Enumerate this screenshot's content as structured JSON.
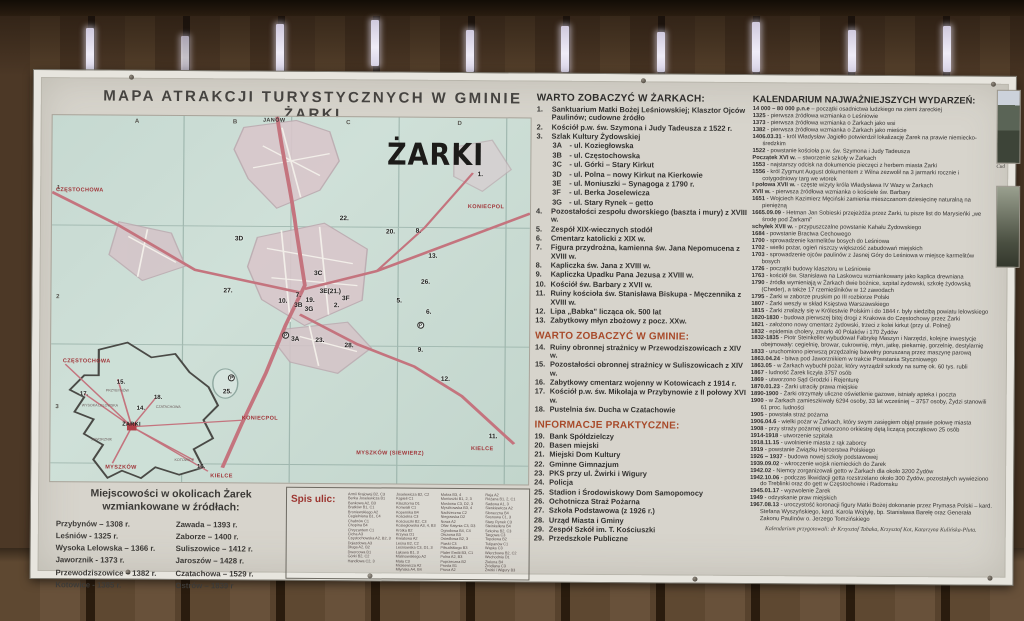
{
  "title": "MAPA ATRAKCJI TURYSTYCZNYCH  W GMINIE ŻARKI",
  "map": {
    "name_label": "ŻARKI",
    "inset_label": "ŻARKI",
    "grid_letters": [
      {
        "t": "A",
        "x": 17.2,
        "y": 0.8
      },
      {
        "t": "B",
        "x": 37.7,
        "y": 0.8
      },
      {
        "t": "C",
        "x": 61.4,
        "y": 0.8
      },
      {
        "t": "D",
        "x": 84.7,
        "y": 0.8
      }
    ],
    "grid_rows": [
      {
        "t": "1",
        "x": 1,
        "y": 19
      },
      {
        "t": "2",
        "x": 1,
        "y": 49
      },
      {
        "t": "3",
        "x": 1,
        "y": 79
      }
    ],
    "red_labels": [
      {
        "t": "JANÓW",
        "x": 44,
        "y": 0.4,
        "cls": "dark"
      },
      {
        "t": "CZĘSTOCHOWA",
        "x": 0.8,
        "y": 19.6
      },
      {
        "t": "KONIECPOL",
        "x": 87,
        "y": 23.5
      },
      {
        "t": "KIELCE",
        "x": 88,
        "y": 89.5
      },
      {
        "t": "MYSZKÓW (SIEWIERZ)",
        "x": 64,
        "y": 91
      },
      {
        "t": "CZĘSTOCHOWA",
        "x": 2.5,
        "y": 66.3
      },
      {
        "t": "KONIECPOL",
        "x": 40,
        "y": 81.6
      },
      {
        "t": "MYSZKÓW",
        "x": 11.5,
        "y": 95.3
      },
      {
        "t": "KIELCE",
        "x": 33.5,
        "y": 97.6
      }
    ],
    "markers": [
      {
        "t": "1.",
        "x": 89,
        "y": 14.4
      },
      {
        "t": "2.",
        "x": 59.1,
        "y": 50.6
      },
      {
        "t": "3A",
        "x": 50.2,
        "y": 59.7
      },
      {
        "t": "3B",
        "x": 50.8,
        "y": 50.6
      },
      {
        "t": "3C",
        "x": 54.9,
        "y": 41.7
      },
      {
        "t": "3D",
        "x": 38.3,
        "y": 32.6
      },
      {
        "t": "3E(21.)",
        "x": 56.1,
        "y": 46.7
      },
      {
        "t": "3F",
        "x": 60.8,
        "y": 48.6
      },
      {
        "t": "3G",
        "x": 53,
        "y": 51.7
      },
      {
        "t": "5.",
        "x": 72.2,
        "y": 49.2
      },
      {
        "t": "6.",
        "x": 78.4,
        "y": 52.2
      },
      {
        "t": "7.",
        "x": 51.1,
        "y": 47.8
      },
      {
        "t": "8.",
        "x": 76.1,
        "y": 30.1
      },
      {
        "t": "9.",
        "x": 76.7,
        "y": 62.7
      },
      {
        "t": "10.",
        "x": 47.5,
        "y": 49.4
      },
      {
        "t": "11.",
        "x": 91.7,
        "y": 86.2
      },
      {
        "t": "12.",
        "x": 81.6,
        "y": 70.4
      },
      {
        "t": "13.",
        "x": 78.8,
        "y": 37
      },
      {
        "t": "19.",
        "x": 53.2,
        "y": 49.2
      },
      {
        "t": "20.",
        "x": 69.9,
        "y": 30.4
      },
      {
        "t": "22.",
        "x": 60.2,
        "y": 26.8
      },
      {
        "t": "23.",
        "x": 55.3,
        "y": 60.2
      },
      {
        "t": "25.",
        "x": 36,
        "y": 74.3
      },
      {
        "t": "26.",
        "x": 77.3,
        "y": 43.9
      },
      {
        "t": "27.",
        "x": 36,
        "y": 46.7
      },
      {
        "t": "28.",
        "x": 61.4,
        "y": 61.6
      }
    ],
    "inset_markers": [
      {
        "t": "14.",
        "x": 18,
        "y": 79.3
      },
      {
        "t": "15.",
        "x": 13.8,
        "y": 72.1
      },
      {
        "t": "16.",
        "x": 30.7,
        "y": 95
      },
      {
        "t": "17.",
        "x": 6.1,
        "y": 75.4
      },
      {
        "t": "18.",
        "x": 21.6,
        "y": 76.2
      }
    ],
    "parking": [
      {
        "t": "P",
        "x": 48.3,
        "y": 58.8
      },
      {
        "t": "P",
        "x": 76.5,
        "y": 55.8
      },
      {
        "t": "P",
        "x": 37.1,
        "y": 70.6
      }
    ],
    "inset_towns": [
      {
        "t": "PRZYBYNÓW",
        "x": 11.5,
        "y": 74.6
      },
      {
        "t": "WYSOKA LELOWSKA",
        "x": 6.5,
        "y": 78.8
      },
      {
        "t": "CZATACHOWA",
        "x": 22,
        "y": 79
      },
      {
        "t": "JAWORZNIK",
        "x": 8.5,
        "y": 88
      },
      {
        "t": "KOTOWICE",
        "x": 26,
        "y": 93.5
      }
    ]
  },
  "towns_box": {
    "header": "Miejscowości w okolicach Żarek wzmiankowane w źródłach:",
    "col1": [
      "Przybynów – 1308 r.",
      "Leśniów - 1325 r.",
      "Wysoka Lelowska – 1366 r.",
      "Jaworznik - 1373 r.",
      "Przewodziszowice – 1382 r.",
      "Kotowice - 1385 r."
    ],
    "col2": [
      "Zawada – 1393 r.",
      "Zaborze – 1400 r.",
      "Suliszowice – 1412 r.",
      "Jaroszów – 1428 r.",
      "Czatachowa – 1529 r.",
      "Ostrów – 1839 r"
    ]
  },
  "streets_box": {
    "header": "Spis ulic:",
    "col1": [
      "Armii Krajowej B2, C3",
      "Berka Joselewicza B1",
      "Bankowa A2, B3",
      "Bratków B1, C1",
      "Broniewskiego A2",
      "Cegielniana B1, C4",
      "Chabrów C1",
      "Chopina B4",
      "Chryzantem C1",
      "Cicha A3",
      "Częstochowska A2, B2, 3",
      "Dojazdowa A3",
      "Długa A2, B2",
      "Dworcowa B1",
      "Górki B2, C2",
      "Handlowa C2, 3"
    ],
    "col2": [
      "Joselewicza B2, C2",
      "Kąpieli C1",
      "Klasztorna D1",
      "Konwalii C1",
      "Kopernika B4",
      "Kościelna C3",
      "Kościuszki B2, C3",
      "Koziegłowska A3, 4, B3",
      "Krótka B2",
      "Krzywa D1",
      "Kwiatowa A2",
      "Leśna B2, C2",
      "Leśniowska C3, D1, 3",
      "Łąkowa B1, 3",
      "Malinowskiego A2",
      "Mała C3",
      "Mickiewicza A2",
      "Młyńska A4, B4"
    ],
    "col3": [
      "Mokra B3, 4",
      "Moniuszki B1, 2, 3",
      "Mostowa C3, D2, 3",
      "Myszkowska B3, 4",
      "Nadrzeczna C2",
      "Niegowska D2",
      "Nowa A2",
      "Ofiar Katynia C3, D3",
      "Ogrodowa B4, C4",
      "Olszowa B3",
      "Osiedlowa B2, 3",
      "Piaski C3",
      "Piłsudskiego B3",
      "Plater Emilii B3, C1",
      "Polna A2, B3",
      "Poprzeczna B2",
      "Prosta B1",
      "Prusa A2"
    ],
    "col4": [
      "Reja A2",
      "Różana B1, 2, C1",
      "Sadowa A1, 3",
      "Sienkiewicza A2",
      "Słoneczna B4",
      "Sosnowa C1, 3",
      "Stary Rynek C3",
      "Steinkellera B4",
      "Szkolna B2, C3",
      "Targowa C3",
      "Topolowa B2",
      "Tulipanów C1",
      "Wąska C3",
      "Wierzbowa B2, C2",
      "Wschodnia D1",
      "Zielona B4",
      "Źródlana C3",
      "Żwirki i Wigury B3"
    ]
  },
  "sights_town": {
    "header": "WARTO ZOBACZYĆ W ŻARKACH:",
    "items": [
      {
        "n": "1.",
        "t": "Sanktuarium Matki Bożej Leśniowskiej; Klasztor Ojców Paulinów; cudowne źródło"
      },
      {
        "n": "2.",
        "t": "Kościół p.w. św. Szymona i Judy Tadeusza z 1522 r."
      },
      {
        "n": "3.",
        "t": "Szlak Kultury Żydowskiej"
      },
      {
        "n": "3A",
        "t": "- ul. Koziegłowska",
        "sub": true
      },
      {
        "n": "3B",
        "t": "- ul. Częstochowska",
        "sub": true
      },
      {
        "n": "3C",
        "t": "- ul. Górki – Stary Kirkut",
        "sub": true
      },
      {
        "n": "3D",
        "t": "- ul. Polna – nowy Kirkut na Kierkowie",
        "sub": true
      },
      {
        "n": "3E",
        "t": "- ul. Moniuszki – Synagoga z 1790 r.",
        "sub": true
      },
      {
        "n": "3F",
        "t": "- ul. Berka Joselewicza",
        "sub": true
      },
      {
        "n": "3G",
        "t": "- ul. Stary Rynek – getto",
        "sub": true
      },
      {
        "n": "4.",
        "t": "Pozostałości zespołu dworskiego (baszta i mury) z XVIII w."
      },
      {
        "n": "5.",
        "t": "Zespół XIX-wiecznych stodół"
      },
      {
        "n": "6.",
        "t": "Cmentarz katolicki z XIX w."
      },
      {
        "n": "7.",
        "t": "Figura przydrożna, kamienna św. Jana Nepomucena z XVIII w."
      },
      {
        "n": "8.",
        "t": "Kapliczka św. Jana z XVIII w."
      },
      {
        "n": "9.",
        "t": "Kapliczka Upadku Pana Jezusa z XVIII w."
      },
      {
        "n": "10.",
        "t": "Kościół św. Barbary z XVII w."
      },
      {
        "n": "11.",
        "t": "Ruiny kościoła św. Stanisława Biskupa - Męczennika z XVIII w."
      },
      {
        "n": "12.",
        "t": "Lipa „Babka” licząca ok. 500 lat"
      },
      {
        "n": "13.",
        "t": "Zabytkowy młyn zbożowy z pocz. XXw."
      }
    ]
  },
  "sights_gmina": {
    "header": "WARTO ZOBACZYĆ W GMINIE:",
    "items": [
      {
        "n": "14.",
        "t": "Ruiny obronnej strażnicy w Przewodziszowicach z XIV w."
      },
      {
        "n": "15.",
        "t": "Pozostałości obronnej strażnicy w Suliszowicach z XIV w."
      },
      {
        "n": "16.",
        "t": "Zabytkowy cmentarz wojenny w Kotowicach z 1914 r."
      },
      {
        "n": "17.",
        "t": "Kościół p.w. św. Mikołaja w Przybynowie z II połowy XVI w."
      },
      {
        "n": "18.",
        "t": "Pustelnia św. Ducha w Czatachowie"
      }
    ]
  },
  "info": {
    "header": "INFORMACJE PRAKTYCZNE:",
    "items": [
      {
        "n": "19.",
        "t": "Bank Spółdzielczy"
      },
      {
        "n": "20.",
        "t": "Basen miejski"
      },
      {
        "n": "21.",
        "t": "Miejski Dom Kultury"
      },
      {
        "n": "22.",
        "t": "Gminne Gimnazjum"
      },
      {
        "n": "23.",
        "t": "PKS przy ul. Żwirki i Wigury"
      },
      {
        "n": "24.",
        "t": "Policja"
      },
      {
        "n": "25.",
        "t": "Stadion i Środowiskowy Dom Samopomocy"
      },
      {
        "n": "26.",
        "t": "Ochotnicza Straż Pożarna"
      },
      {
        "n": "27.",
        "t": "Szkoła Podstawowa (z 1926 r.)"
      },
      {
        "n": "28.",
        "t": "Urząd Miasta i Gminy"
      },
      {
        "n": "29.",
        "t": "Zespół Szkół im. T. Kościuszki"
      },
      {
        "n": "29.",
        "t": "Przedszkole Publiczne"
      }
    ]
  },
  "kalendarium": {
    "header": "KALENDARIUM NAJWAŻNIEJSZYCH WYDARZEŃ:",
    "entries": [
      {
        "d": "14 000 – 80 000 p.n.e",
        "t": "– początki osadnictwa ludzkiego na ziemi żareckiej"
      },
      {
        "d": "1325",
        "t": "- pierwsza źródłowa wzmianka o Leśniowie"
      },
      {
        "d": "1373",
        "t": "- pierwsza źródłowa wzmianka o Żarkach jako wsi"
      },
      {
        "d": "1382",
        "t": "- pierwsza źródłowa wzmianka o Żarkach jako mieście"
      },
      {
        "d": "1406.03.31",
        "t": "- król Władysław Jagiełło potwierdził lokalizację Żarek na prawie niemiecko-średzkim"
      },
      {
        "d": "1522",
        "t": "- powstanie kościoła p.w. św. Szymona i Judy Tadeusza"
      },
      {
        "d": "Początek XVI w.",
        "t": "– stworzenie szkoły w Żarkach"
      },
      {
        "d": "1553",
        "t": "- najstarszy odcisk na dokumencie pieczęci z herbem miasta Żarki"
      },
      {
        "d": "1556",
        "t": "- król Zygmunt August dokumentem z Wilna zezwolił na 3 jarmarki rocznie i cotygodniowy targ we wtorek"
      },
      {
        "d": "I połowa XVII w.",
        "t": "- częste wizyty króla Władysława IV Wazy w Żarkach"
      },
      {
        "d": "XVII w.",
        "t": "- pierwsza źródłowa wzmianka o kościele św. Barbary"
      },
      {
        "d": "1651",
        "t": "- Wojciech Kazimierz Męciński zamienia mieszczanom dziesięcinę naturalną na pieniężną"
      },
      {
        "d": "1665.09.09",
        "t": "- Hetman Jan Sobieski przejeżdża przez Żarki, tu pisze list do Marysieńki „we środę pod Żarkami”"
      },
      {
        "d": "schyłek XVII w.",
        "t": "- przypuszczalne powstanie Kahału Żydowskiego"
      },
      {
        "d": "1684",
        "t": "- powstanie Bractwa Cechowego"
      },
      {
        "d": "1700",
        "t": "- sprowadzenie karmelitów bosych do Leśniowa"
      },
      {
        "d": "1702",
        "t": "- wielki pożar, ogień niszczy większość zabudowań miejskich"
      },
      {
        "d": "1703",
        "t": "- sprowadzenie ojców paulinów z Jasnej Góry do Leśniowa w miejsce karmelitów bosych"
      },
      {
        "d": "1726",
        "t": "- początki budowy klasztoru w Leśniowie"
      },
      {
        "d": "1763",
        "t": "- kościół św. Stanisława na Laskowcu wzmiankowany jako kaplica drewniana"
      },
      {
        "d": "1790",
        "t": "- źródła wymieniają w Żarkach dwie bożnice, szpital żydowski, szkołę żydowską (Cheder), a także 17 rzemieślników w 12 zawodach"
      },
      {
        "d": "1795",
        "t": "- Żarki w zaborze pruskim po III rozbiorze Polski"
      },
      {
        "d": "1807",
        "t": "- Żarki weszły w skład Księstwa Warszawskiego"
      },
      {
        "d": "1815",
        "t": "- Żarki znalazły się w Królestwie Polskim i do 1844 r. były siedzibą powiatu lelowskiego"
      },
      {
        "d": "1820-1830",
        "t": "- budowa pierwszej bitej drogi z Krakowa do Częstochowy przez Żarki"
      },
      {
        "d": "1821",
        "t": "- założono nowy cmentarz żydowski, trzeci z kolei kirkut (przy ul. Polnej)"
      },
      {
        "d": "1832",
        "t": "- epidemia cholery, zmarło 40 Polaków i 170 Żydów"
      },
      {
        "d": "1832-1835",
        "t": "- Piotr Steinkeller wybudował Fabrykę Maszyn i Narzędzi, kolejne inwestycje obejmowały: cegielnię, browar, cukrownię, młyn, jatkę, piekarnię, gorzelnię, destylarnię"
      },
      {
        "d": "1833",
        "t": "- uruchomiono pierwszą przędzalnię bawełny poruszaną przez maszynę parową"
      },
      {
        "d": "1863.04.24",
        "t": "- bitwa pod Jaworznikiem w trakcie Powstania Styczniowego"
      },
      {
        "d": "1863.05",
        "t": "- w Żarkach wybuchł pożar, który wyrządził szkody na sumę ok. 60 tys. rubli"
      },
      {
        "d": "1867",
        "t": "- ludność Żarek liczyła 3757 osób"
      },
      {
        "d": "1869",
        "t": "- utworzono Sąd Grodzki i Rejenturę"
      },
      {
        "d": "1870.01.23",
        "t": "- Żarki utraciły prawa miejskie"
      },
      {
        "d": "1890-1900",
        "t": "- Żarki otrzymały uliczne oświetlenie gazowe, istniały apteka i poczta"
      },
      {
        "d": "1900",
        "t": "- w Żarkach zamieszkiwały 6294 osoby, 33 lat wcześniej – 3757 osoby, Żydzi stanowili 61 proc. ludności"
      },
      {
        "d": "1905",
        "t": "- powstała straż pożarna"
      },
      {
        "d": "1906.04.6",
        "t": "- wielki pożar w Żarkach, który swym zasięgiem objął prawie połowę miasta"
      },
      {
        "d": "1908",
        "t": "- przy straży pożarnej utworzono orkiestrę dętą liczącą początkowo 25 osób"
      },
      {
        "d": "1914-1918",
        "t": "- utworzenie szpitala"
      },
      {
        "d": "1918.11.15",
        "t": "- uwolnienie miasta z rąk zaborcy"
      },
      {
        "d": "1919",
        "t": "- powstanie Związku Harcerstwa Polskiego"
      },
      {
        "d": "1926 – 1937",
        "t": "- budowa nowej szkoły podstawowej"
      },
      {
        "d": "1939.09.02",
        "t": "- wkroczenie wojsk niemieckich do Żarek"
      },
      {
        "d": "1942.02",
        "t": "- Niemcy zorganizowali getto w Żarkach dla około 3200 Żydów"
      },
      {
        "d": "1942.10.06",
        "t": "- podczas likwidacji getta rozstrzelano około 300 Żydów, pozostałych wywieziono do Treblinki oraz do gett w Częstochowie i Radomsku"
      },
      {
        "d": "1945.01.17",
        "t": "- wyzwolenie Żarek"
      },
      {
        "d": "1949",
        "t": "- odzyskanie praw miejskich"
      },
      {
        "d": "1967.08.13",
        "t": "- uroczystość koronacji figury Matki Bożej dokonanie przez Prymasa Polski – kard. Stefana Wyszyńskiego, kard. Karola Wojtyłę, bp. Stanisława Barełę oraz Generała Zakonu Paulinów o. Jerzego Tomzińskiego"
      }
    ],
    "credit": "Kalendarium przygotowali: dr Krzysztof Tabaka, Krzysztof Kot, Katarzyna Kulińska-Pluta."
  },
  "photos": {
    "caption": "Cud"
  }
}
